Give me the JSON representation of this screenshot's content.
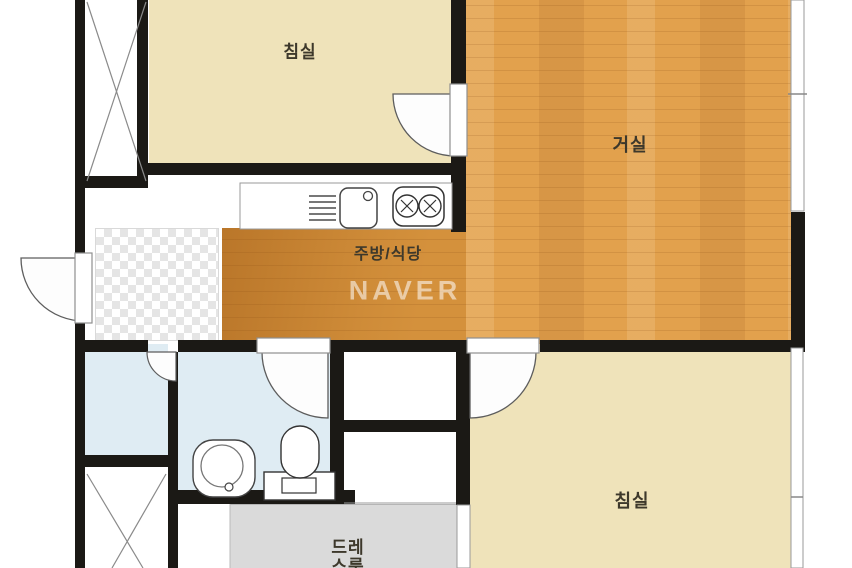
{
  "plan": {
    "watermark": "NAVER",
    "rooms": {
      "bedroom_top": {
        "label": "침실"
      },
      "living_room": {
        "label": "거실"
      },
      "kitchen_dining": {
        "label": "주방/식당"
      },
      "bedroom_bottom": {
        "label": "침실"
      },
      "dressing_room": {
        "label_line1": "드레",
        "label_line2": "스룸"
      }
    },
    "fixtures": [
      "dish-rack",
      "kitchen-sink",
      "gas-stove",
      "wash-basin",
      "toilet"
    ],
    "colors": {
      "wall": "#1b1915",
      "bedroom_floor": "#efe3ba",
      "wood_floor": "#e2a14d",
      "wood_dark": "#c4812e",
      "bathroom_floor": "#dfecf3",
      "dressing_floor": "#dadada",
      "entrance_tile": "#e5e5e5",
      "watermark_color": "rgba(255,255,255,0.55)"
    }
  }
}
